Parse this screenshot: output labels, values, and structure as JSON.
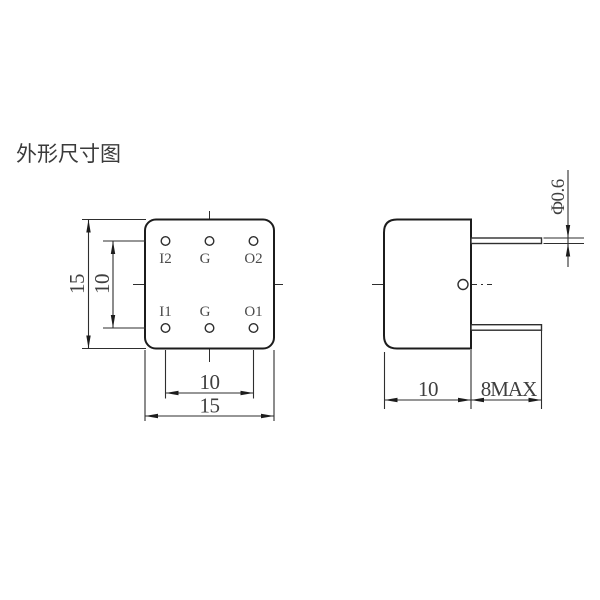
{
  "title": "外形尺寸图",
  "colors": {
    "outline": "#1c1c1c",
    "thin_line": "#2e2e2e",
    "text": "#3f3f3f",
    "background": "#ffffff"
  },
  "top_view": {
    "pins": [
      {
        "label": "I2"
      },
      {
        "label": "G"
      },
      {
        "label": "O2"
      },
      {
        "label": "I1"
      },
      {
        "label": "G"
      },
      {
        "label": "O1"
      }
    ],
    "dims": {
      "body_height": "15",
      "pin_row_spacing": "10",
      "pin_col_spacing": "10",
      "body_width": "15"
    }
  },
  "side_view": {
    "dims": {
      "pin_diameter": "Φ0.6",
      "body_depth": "10",
      "pin_length": "8MAX"
    }
  }
}
